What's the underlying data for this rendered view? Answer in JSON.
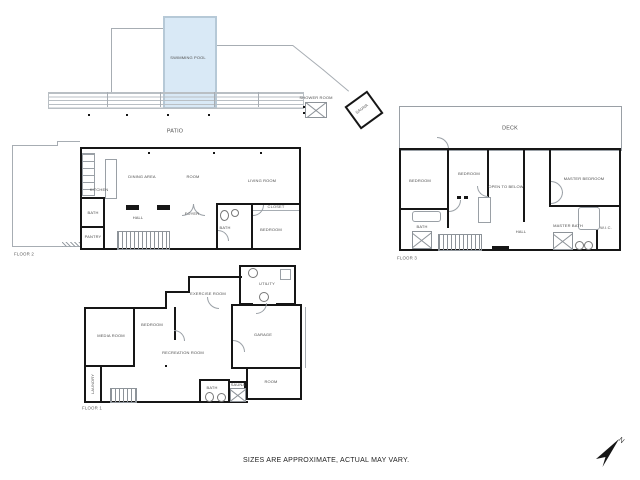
{
  "disclaimer": "SIZES ARE APPROXIMATE, ACTUAL MAY VARY.",
  "compass": {
    "north_label": "N"
  },
  "colors": {
    "wall": "#161616",
    "thin_line": "#a7adb3",
    "pool_fill": "#d9e9f6",
    "pool_border": "#b6c9d7",
    "label_text": "#4d4d4d",
    "background": "#ffffff"
  },
  "floor2": {
    "label": "FLOOR 2",
    "rooms": {
      "swimming_pool": "SWIMMING POOL",
      "patio": "PATIO",
      "shower_room": "SHOWER ROOM",
      "sauna": "SAUNA",
      "kitchen": "KITCHEN",
      "dining_area": "DINING AREA",
      "room": "ROOM",
      "living_room": "LIVING ROOM",
      "hall": "HALL",
      "foyer": "FOYER",
      "bath": "BATH",
      "bath_small": "BATH",
      "pantry": "PANTRY",
      "closet": "CLOSET",
      "bedroom": "BEDROOM"
    }
  },
  "floor3": {
    "label": "FLOOR 3",
    "rooms": {
      "deck": "DECK",
      "bedroom_left": "BEDROOM",
      "bedroom_mid": "BEDROOM",
      "open_to_below": "OPEN TO BELOW",
      "master_bedroom": "MASTER BEDROOM",
      "bath": "BATH",
      "hall": "HALL",
      "master_bath": "MASTER BATH",
      "wic": "W.I.C."
    }
  },
  "floor1": {
    "label": "FLOOR 1",
    "rooms": {
      "exercise_room": "EXERCISE ROOM",
      "utility": "UTILITY",
      "bedroom": "BEDROOM",
      "media_room": "MEDIA ROOM",
      "recreation_room": "RECREATION ROOM",
      "garage": "GARAGE",
      "bath": "BATH",
      "sauna": "SAUNA",
      "room": "ROOM",
      "laundry": "LAUNDRY"
    }
  }
}
